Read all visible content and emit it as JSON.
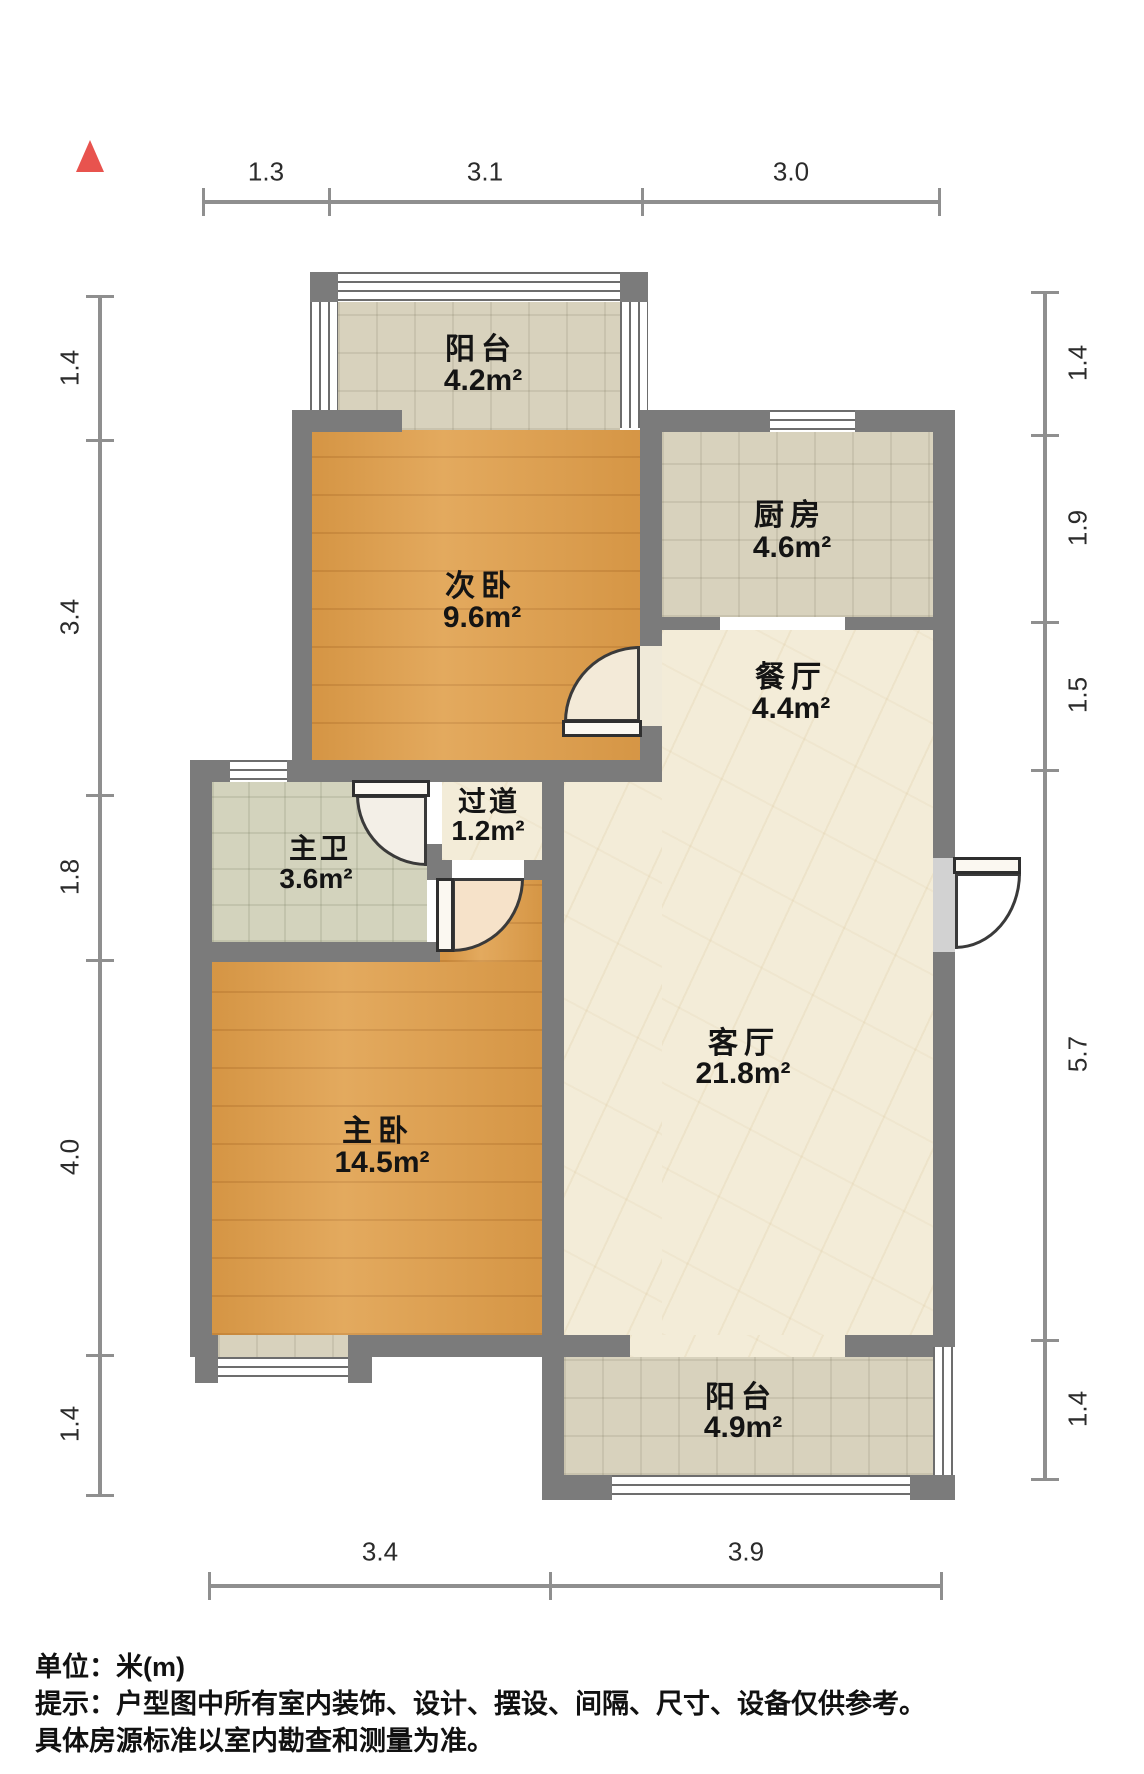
{
  "title": "户型图",
  "compass": {
    "icon": "north-arrow",
    "color": "#e8534e"
  },
  "colors": {
    "wall": "#7b7b7b",
    "wood_floor": "#e0a04c",
    "tile_floor": "#d8d2bd",
    "bath_tile_floor": "#d3d3bd",
    "marble_floor": "#f3ecd8",
    "window": "#ffffff",
    "door_swing": "#f3ead8"
  },
  "rooms": [
    {
      "name": "阳台",
      "area": "4.2m²"
    },
    {
      "name": "次卧",
      "area": "9.6m²"
    },
    {
      "name": "厨房",
      "area": "4.6m²"
    },
    {
      "name": "餐厅",
      "area": "4.4m²"
    },
    {
      "name": "过道",
      "area": "1.2m²"
    },
    {
      "name": "主卫",
      "area": "3.6m²"
    },
    {
      "name": "主卧",
      "area": "14.5m²"
    },
    {
      "name": "客厅",
      "area": "21.8m²"
    },
    {
      "name": "阳台",
      "area": "4.9m²"
    }
  ],
  "dimensions": {
    "top": [
      "1.3",
      "3.1",
      "3.0"
    ],
    "left": [
      "1.4",
      "3.4",
      "1.8",
      "4.0",
      "1.4"
    ],
    "right": [
      "1.4",
      "1.9",
      "1.5",
      "5.7",
      "1.4"
    ],
    "bottom": [
      "3.4",
      "3.9"
    ]
  },
  "footer": {
    "unit_line": "单位：米(m)",
    "tip_line1": "提示：户型图中所有室内装饰、设计、摆设、间隔、尺寸、设备仅供参考。",
    "tip_line2": "具体房源标准以室内勘查和测量为准。"
  }
}
